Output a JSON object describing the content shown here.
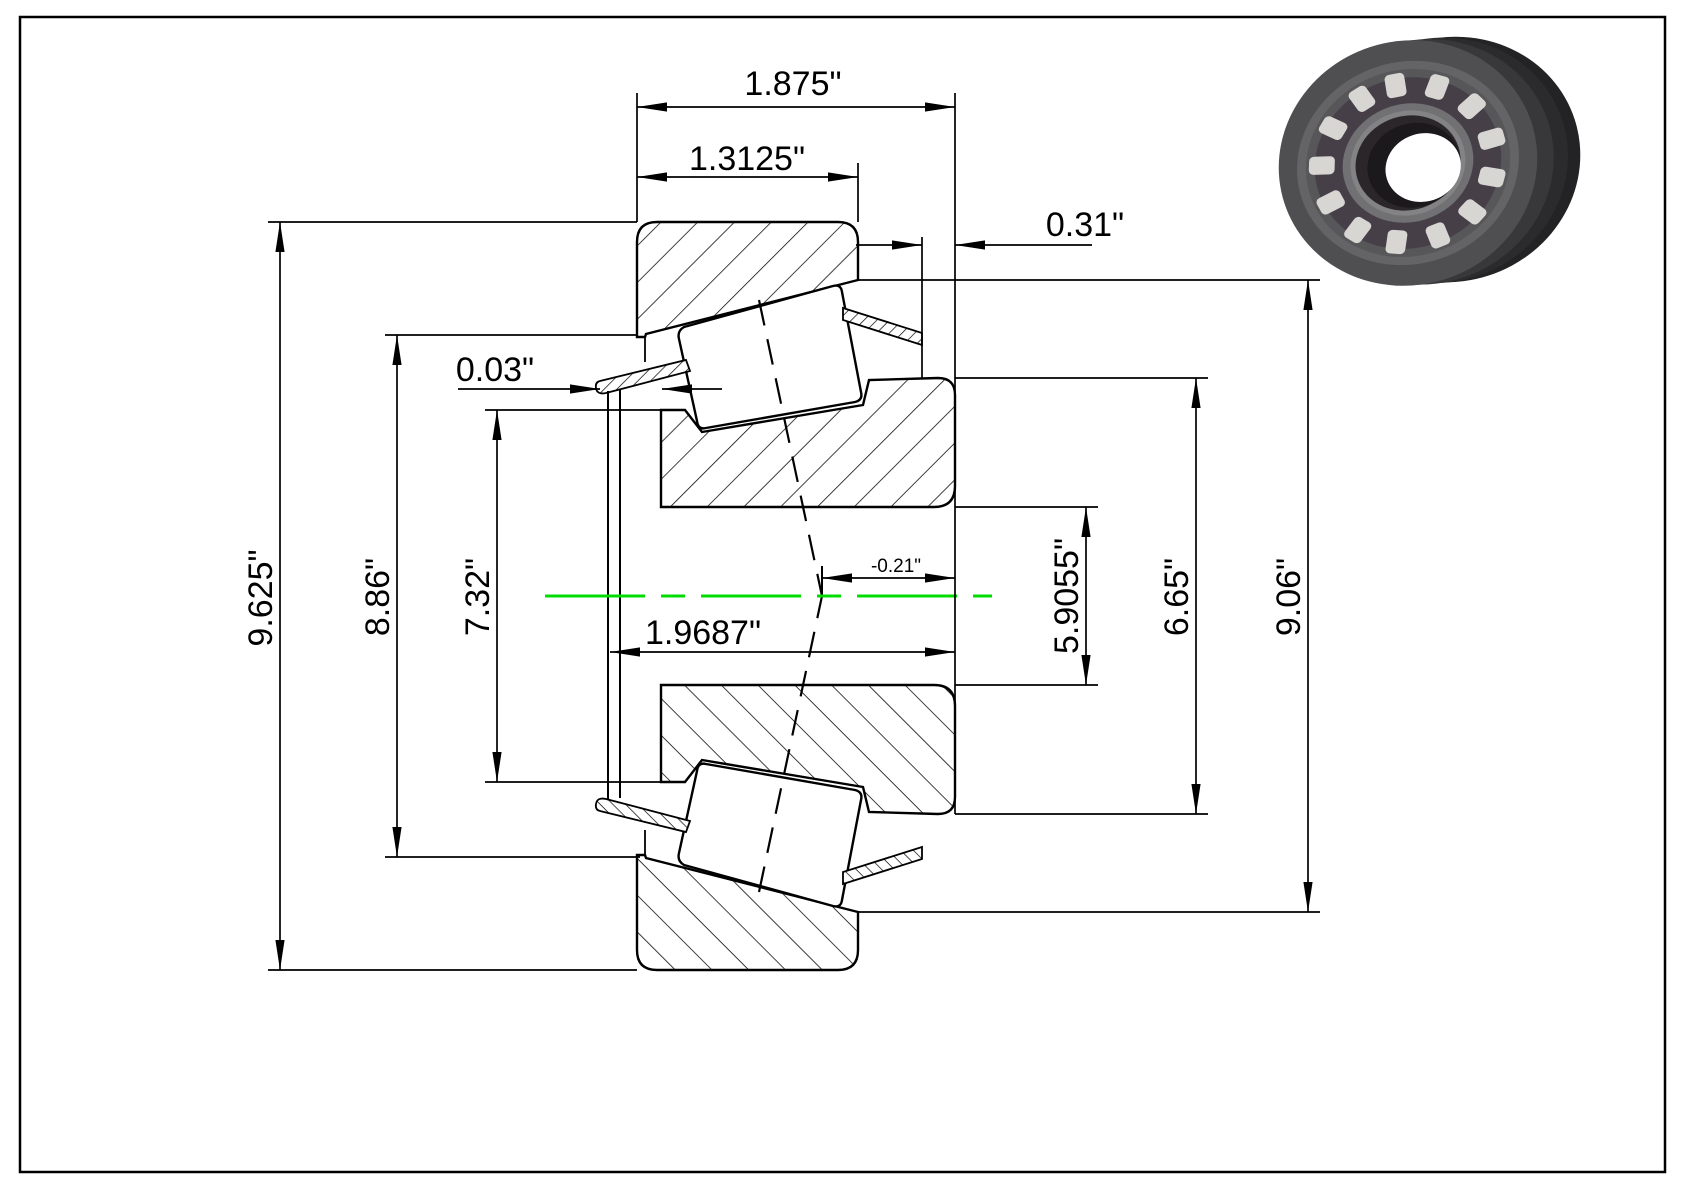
{
  "drawing": {
    "dimensions": {
      "overall_width": "1.875\"",
      "cup_width": "1.3125\"",
      "back_offset": "0.31\"",
      "cage_thickness": "0.03\"",
      "flange_diameter": "9.625\"",
      "diameter_8_86": "8.86\"",
      "diameter_7_32": "7.32\"",
      "cone_width": "1.9687\"",
      "effective_center": "-0.21\"",
      "bore_diameter": "5.9055\"",
      "diameter_6_65": "6.65\"",
      "outer_diameter": "9.06\""
    },
    "colors": {
      "centerline": "#00DC00",
      "ink": "#000000",
      "background": "#FFFFFF"
    },
    "icons": {
      "thumbnail": "tapered-roller-bearing-3d-render"
    }
  }
}
